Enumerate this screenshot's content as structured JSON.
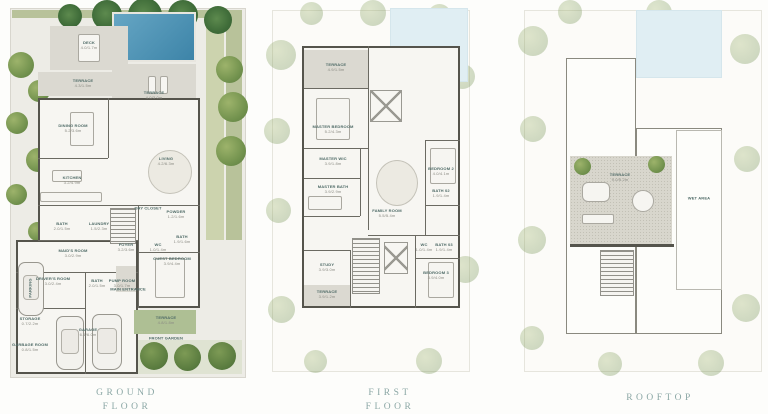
{
  "colors": {
    "pool": "#4e96ba",
    "greenery": "#b8c29a",
    "terrace": "#dbd9d1",
    "wall": "#55544c",
    "caption_text": "#8ba7a5"
  },
  "captions": {
    "ground_line1": "GROUND",
    "ground_line2": "FLOOR",
    "first_line1": "FIRST",
    "first_line2": "FLOOR",
    "rooftop_line1": "ROOFTOP"
  },
  "ground": {
    "rooms": [
      {
        "name": "DECK",
        "dim": "4.0/1.7m"
      },
      {
        "name": "TERRACE",
        "dim": "4.3/1.5m"
      },
      {
        "name": "TERRACE",
        "dim": "4.0/3.0m"
      },
      {
        "name": "DINING ROOM",
        "dim": "5.2/3.6m"
      },
      {
        "name": "KITCHEN",
        "dim": "3.2/4.9m"
      },
      {
        "name": "LIVING",
        "dim": "4.2/6.3m"
      },
      {
        "name": "DRY CLOSET",
        "dim": ""
      },
      {
        "name": "POWDER",
        "dim": "1.2/1.6m"
      },
      {
        "name": "FOYER",
        "dim": "3.2/3.6m"
      },
      {
        "name": "WC",
        "dim": "1.0/1.4m"
      },
      {
        "name": "BATH",
        "dim": "1.9/1.6m"
      },
      {
        "name": "GUEST BEDROOM",
        "dim": "3.9/4.4m"
      },
      {
        "name": "MAIN ENTRANCE",
        "dim": ""
      },
      {
        "name": "BATH",
        "dim": "2.0/1.5m"
      },
      {
        "name": "LAUNDRY",
        "dim": "1.5/2.3m"
      },
      {
        "name": "MAID'S ROOM",
        "dim": "3.0/2.9m"
      },
      {
        "name": "DRIVER'S ROOM",
        "dim": "3.0/2.4m"
      },
      {
        "name": "BATH",
        "dim": "2.0/1.5m"
      },
      {
        "name": "PUMP ROOM",
        "dim": "3.0/1.7m"
      },
      {
        "name": "PARKING",
        "dim": ""
      },
      {
        "name": "STORAGE",
        "dim": "0.7/2.2m"
      },
      {
        "name": "GARBAGE ROOM",
        "dim": "0.8/1.5m"
      },
      {
        "name": "GARAGE",
        "dim": "6.1/6.0m"
      },
      {
        "name": "TERRACE",
        "dim": "4.8/1.8m"
      },
      {
        "name": "FRONT GARDEN",
        "dim": ""
      }
    ]
  },
  "first": {
    "rooms": [
      {
        "name": "TERRACE",
        "dim": "4.9/1.5m"
      },
      {
        "name": "MASTER BEDROOM",
        "dim": "5.2/4.3m"
      },
      {
        "name": "MASTER WIC",
        "dim": "3.9/1.8m"
      },
      {
        "name": "MASTER BATH",
        "dim": "3.9/2.9m"
      },
      {
        "name": "FAMILY ROOM",
        "dim": "5.5/5.4m"
      },
      {
        "name": "BEDROOM 2",
        "dim": "4.0/4.1m"
      },
      {
        "name": "BATH 02",
        "dim": "1.9/1.4m"
      },
      {
        "name": "WC",
        "dim": "1.0/1.4m"
      },
      {
        "name": "BATH 03",
        "dim": "1.9/1.4m"
      },
      {
        "name": "BEDROOM 3",
        "dim": "3.9/4.0m"
      },
      {
        "name": "STUDY",
        "dim": "3.9/3.0m"
      },
      {
        "name": "TERRACE",
        "dim": "3.9/1.2m"
      }
    ]
  },
  "rooftop": {
    "rooms": [
      {
        "name": "TERRACE",
        "dim": "9.0/5.2m"
      },
      {
        "name": "WET AREA",
        "dim": ""
      }
    ]
  }
}
